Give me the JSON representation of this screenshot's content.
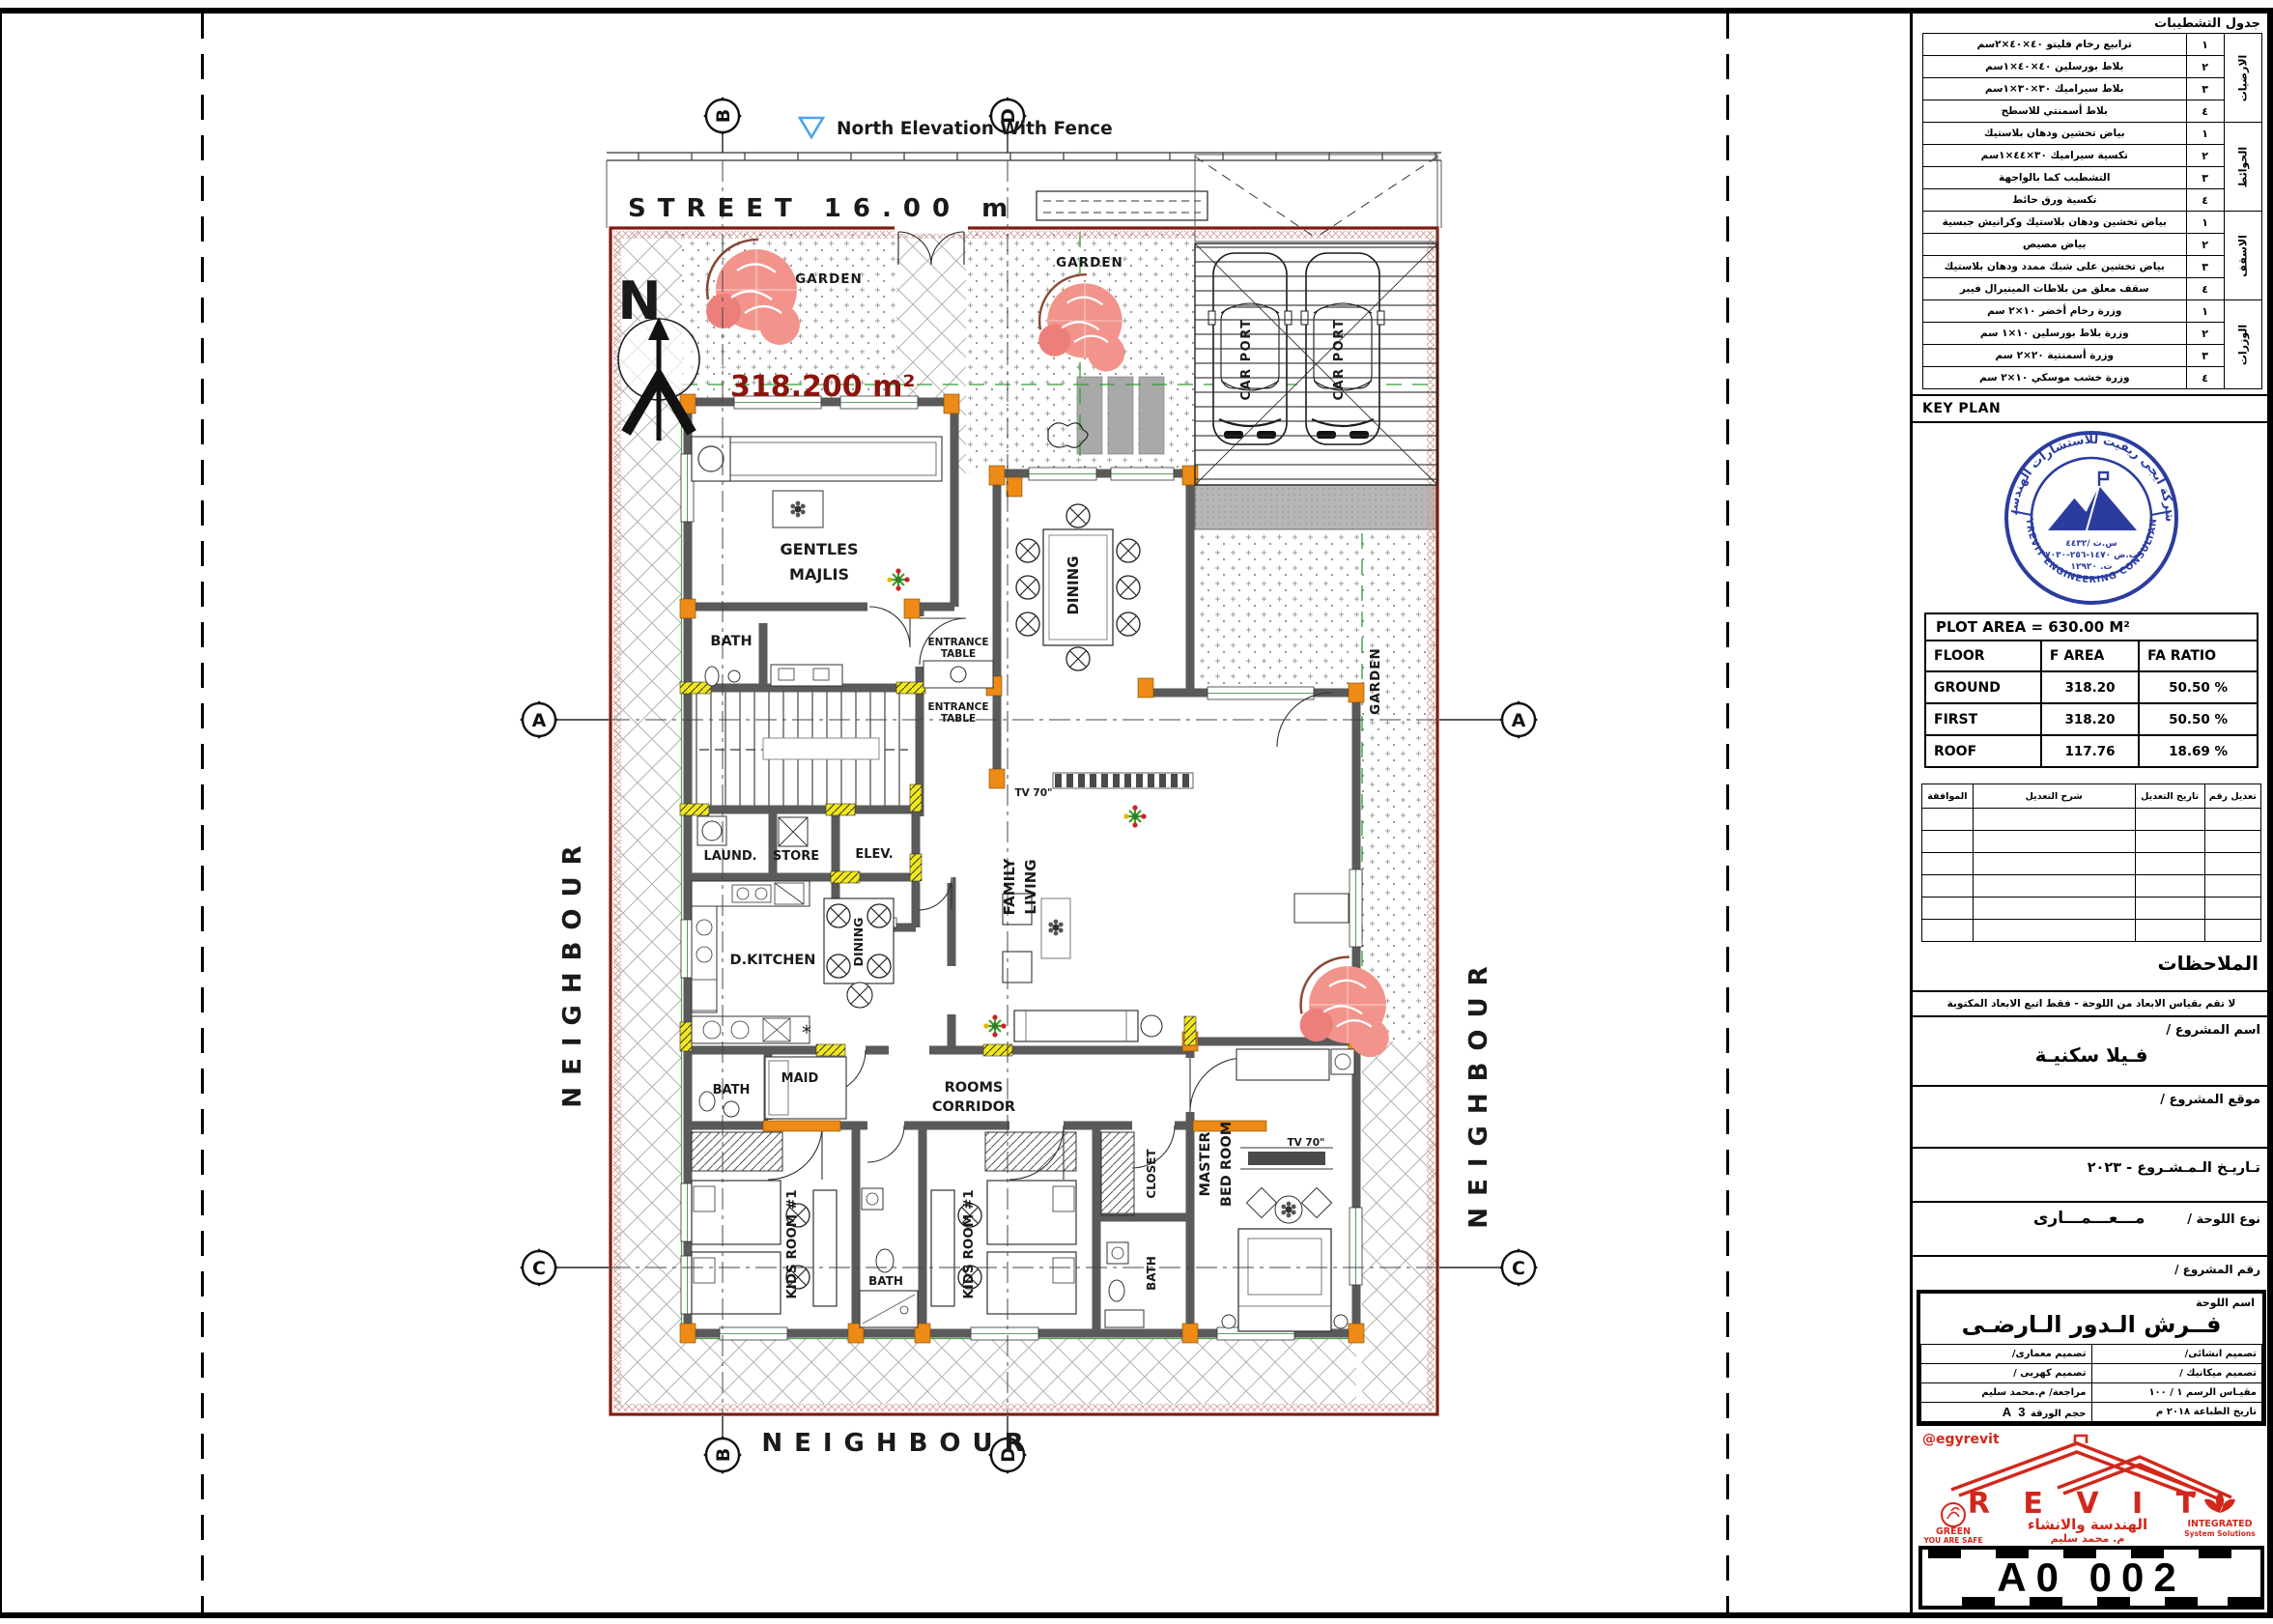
{
  "title_block": {
    "finishing": {
      "title": "جدول التشطيبات",
      "groups": [
        {
          "name": "الارضيات",
          "rows": [
            {
              "no": "١",
              "desc": "ترابيع رخام فليتو  ٤٠×٤٠×٢سم"
            },
            {
              "no": "٢",
              "desc": "بلاط بورسلين  ٤٠×٤٠×١سم"
            },
            {
              "no": "٣",
              "desc": "بلاط سيراميك  ٣٠×٣٠×١سم"
            },
            {
              "no": "٤",
              "desc": "بلاط أسمنتي للاسطح"
            }
          ]
        },
        {
          "name": "الحوائط",
          "rows": [
            {
              "no": "١",
              "desc": "بياض تخشين ودهان بلاستيك"
            },
            {
              "no": "٢",
              "desc": "تكسية سيراميك ٣٠×٤٤×١سم"
            },
            {
              "no": "٣",
              "desc": "التشطيب كما بالواجهة"
            },
            {
              "no": "٤",
              "desc": "تكسية ورق حائط"
            }
          ]
        },
        {
          "name": "الاسقف",
          "rows": [
            {
              "no": "١",
              "desc": "بياض تخشين ودهان بلاستيك وكرانيش جبسية"
            },
            {
              "no": "٢",
              "desc": "بياض مصيص"
            },
            {
              "no": "٣",
              "desc": "بياض تخشين على شبك ممدد ودهان بلاستيك"
            },
            {
              "no": "٤",
              "desc": "سقف معلق من بلاطات المينيرال فيبر"
            }
          ]
        },
        {
          "name": "الوزرات",
          "rows": [
            {
              "no": "١",
              "desc": "وزرة رخام أخضر  ١٠×٢ سم"
            },
            {
              "no": "٢",
              "desc": "وزرة بلاط بورسلين  ١٠×١ سم"
            },
            {
              "no": "٣",
              "desc": "وزرة أسمنتية  ٢٠×٢ سم"
            },
            {
              "no": "٤",
              "desc": "وزرة خشب موسكي  ١٠×٢ سم"
            }
          ]
        }
      ]
    },
    "key_plan": {
      "label": "KEY PLAN",
      "stamp_top": "شركة ايجي ريفيت للاستشارات الهندسية",
      "stamp_bottom": "EGYREVIT ENGINEERING CONSULTANCY",
      "stamp_line1": "س.ت /٤٤٣٢",
      "stamp_line2": "ب.ض ١٤٧٠-٢٥٦-٧٠٣٠",
      "stamp_line3": "ت. ١٢٩٢٠"
    },
    "plot": {
      "title": "PLOT AREA = 630.00 M²",
      "headers": [
        "FLOOR",
        "F AREA",
        "FA RATIO"
      ],
      "rows": [
        [
          "GROUND",
          "318.20",
          "50.50 %"
        ],
        [
          "FIRST",
          "318.20",
          "50.50 %"
        ],
        [
          "ROOF",
          "117.76",
          "18.69 %"
        ]
      ]
    },
    "revisions": {
      "headers": [
        "تعديل رقم",
        "تاريخ التعديل",
        "شرح التعديل",
        "الموافقة"
      ]
    },
    "remarks_title": "الملاحظات",
    "notice": "لا تقم بقياس الابعاد من اللوحة - فقط اتبع الابعاد المكتوبة",
    "project": {
      "name_label": "اسم المشروع /",
      "name_value": "فـيلا سكنيـة",
      "location_label": "موقع المشروع /",
      "date_label": "تـاريـخ الـمـشـروع -  ٢٠٢٣",
      "type_label": "نوع اللوحة /",
      "type_value": "مـــعـــمـــارى",
      "number_label": "رقم المشروع /"
    },
    "sheet_name": {
      "label": "اسم اللوحة",
      "value": "فــرش الـدور الـارضـى"
    },
    "credits": {
      "arch": "تصميم معمارى/",
      "struct": "تصميم انشائى/",
      "elec": "تصميم كهربى /",
      "mech": "تصميم ميكانيك /",
      "review": "مراجعة/ م.محمد سليم",
      "scale_label": "مقيـاس الرسم",
      "scale_value": "١ / ١٠٠",
      "paper_label": "حجم الورقة",
      "paper_value": "A 3",
      "print_label": "تاريخ الطباعة",
      "print_value": "٢٠١٨ م"
    },
    "logo": {
      "handle": "@egyrevit",
      "brand": "R E V I T",
      "tagline": "الهندسة والانشاء",
      "person": "م. محمد سليم",
      "left1": "GREEN",
      "left2": "YOU ARE SAFE",
      "right1": "INTEGRATED",
      "right2": "System Solutions"
    },
    "sheet_number": "A0 002"
  },
  "plan": {
    "street": "STREET 16.00 m",
    "north_elevation": "North Elevation With Fence",
    "neighbour": "NEIGHBOUR",
    "area_value": "318.200 m²",
    "north_letter": "N",
    "garden": "GARDEN",
    "car_port": "CAR PORT",
    "grid": {
      "a": "A",
      "b": "B",
      "c": "C",
      "d": "D"
    },
    "rooms": {
      "gentles_1": "GENTLES",
      "gentles_2": "MAJLIS",
      "bath": "BATH",
      "entrance": "ENTRANCE",
      "table": "TABLE",
      "dining": "DINING",
      "laundry": "LAUND.",
      "store": "STORE",
      "elevator": "ELEV.",
      "d_kitchen": "D.KITCHEN",
      "family_1": "FAMILY",
      "family_2": "LIVING",
      "maid": "MAID",
      "corridor_1": "ROOMS",
      "corridor_2": "CORRIDOR",
      "kids_room": "KIDS ROOM #1",
      "closet": "CLOSET",
      "master_1": "MASTER",
      "master_2": "BED ROOM",
      "tv": "TV 70\""
    }
  }
}
